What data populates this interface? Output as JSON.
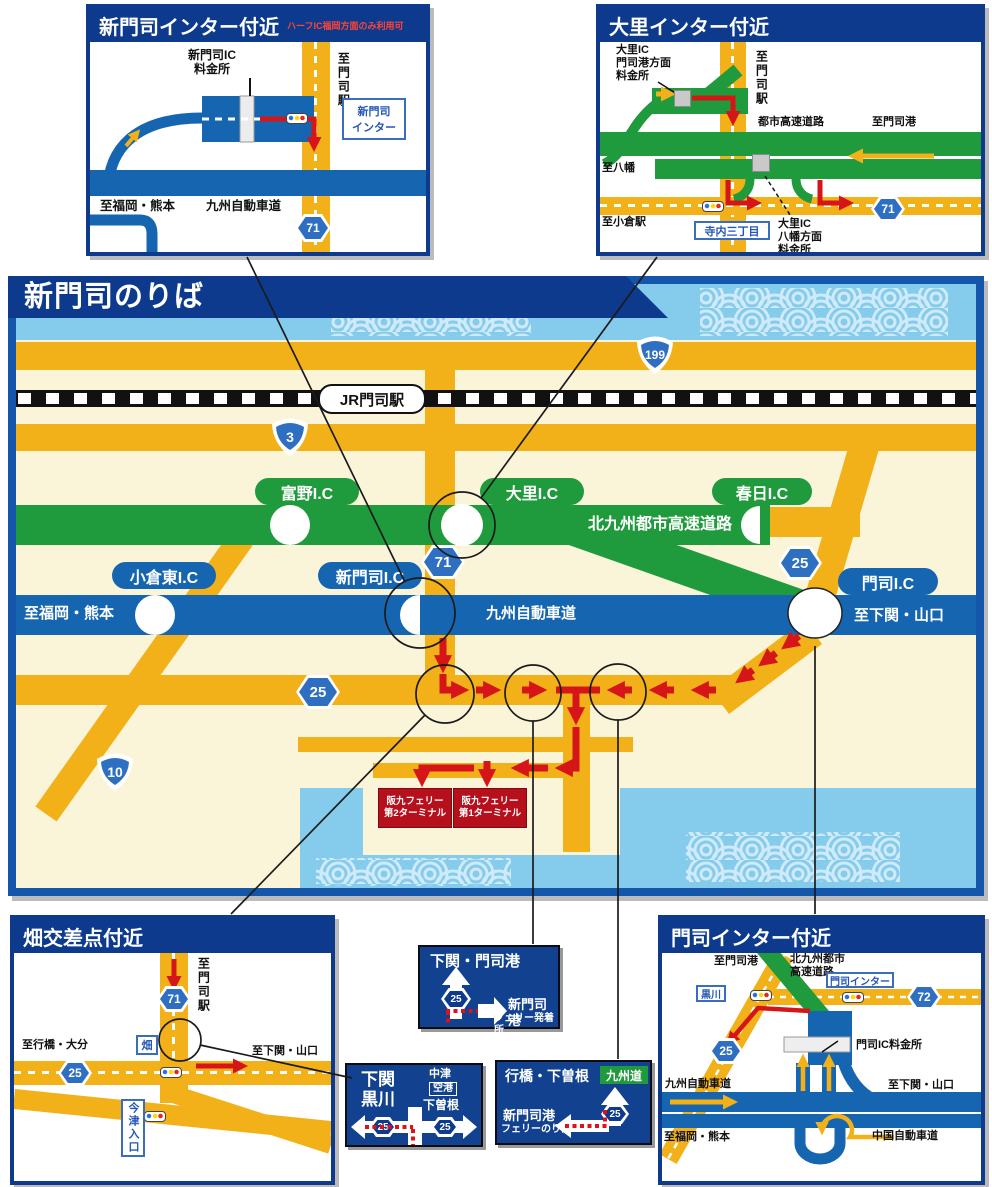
{
  "shields": {
    "r3": "3",
    "r10": "10",
    "r25": "25",
    "r71": "71",
    "r72": "72",
    "r199": "199"
  },
  "inset_tl": {
    "title": "新門司インター付近",
    "subtitle": "ハーフIC福岡方面のみ利用可",
    "tollgate": "新門司IC\n料金所",
    "ic_box": "新門司\nインター",
    "to_station": "至門司駅",
    "to_fukuoka": "至福岡・熊本",
    "expressway": "九州自動車道"
  },
  "inset_tr": {
    "title": "大里インター付近",
    "tollgate_moji": "大里IC\n門司港方面\n料金所",
    "tollgate_yahata": "大里IC\n八幡方面\n料金所",
    "to_station": "至門司駅",
    "urban_expressway": "都市高速道路",
    "to_mojiko": "至門司港",
    "to_yahata": "至八幡",
    "to_kokura": "至小倉駅",
    "terauchi": "寺内三丁目"
  },
  "main": {
    "title": "新門司のりば",
    "station": "JR門司駅",
    "ic_tomino": "富野I.C",
    "ic_dairi": "大里I.C",
    "ic_kasuga": "春日I.C",
    "ic_kokurahigashi": "小倉東I.C",
    "ic_shinmoji": "新門司I.C",
    "ic_moji": "門司I.C",
    "urban_expressway": "北九州都市高速道路",
    "kyushu_expressway": "九州自動車道",
    "to_fukuoka": "至福岡・熊本",
    "to_shimonoseki": "至下関・山口",
    "terminal2": "阪九フェリー\n第2ターミナル",
    "terminal1": "阪九フェリー\n第1ターミナル"
  },
  "inset_bl": {
    "title": "畑交差点付近",
    "to_station": "至門司駅",
    "to_yukuhashi": "至行橋・大分",
    "to_shimonoseki": "至下関・山口",
    "hata": "畑",
    "imazu": "今津入口"
  },
  "inset_br": {
    "title": "門司インター付近",
    "to_mojiko": "至門司港",
    "urban_expressway": "北九州都市\n高速道路",
    "moji_inter": "門司インター",
    "kurokawa": "黒川",
    "tollgate": "門司IC料金所",
    "kyushu_expressway": "九州自動車道",
    "to_shimonoseki": "至下関・山口",
    "to_fukuoka": "至福岡・熊本",
    "chugoku_expressway": "中国自動車道"
  },
  "sign_a": {
    "title": "下関・門司港",
    "dest": "新門司港",
    "dest2": "フェリー発着所"
  },
  "sign_b": {
    "left1": "下関",
    "left2": "黒川",
    "top": "中津",
    "airport": "空港",
    "bottom": "下曽根"
  },
  "sign_c": {
    "title": "行橋・下曽根",
    "expressway": "九州道",
    "dest": "新門司港",
    "dest2": "フェリーのりば"
  }
}
